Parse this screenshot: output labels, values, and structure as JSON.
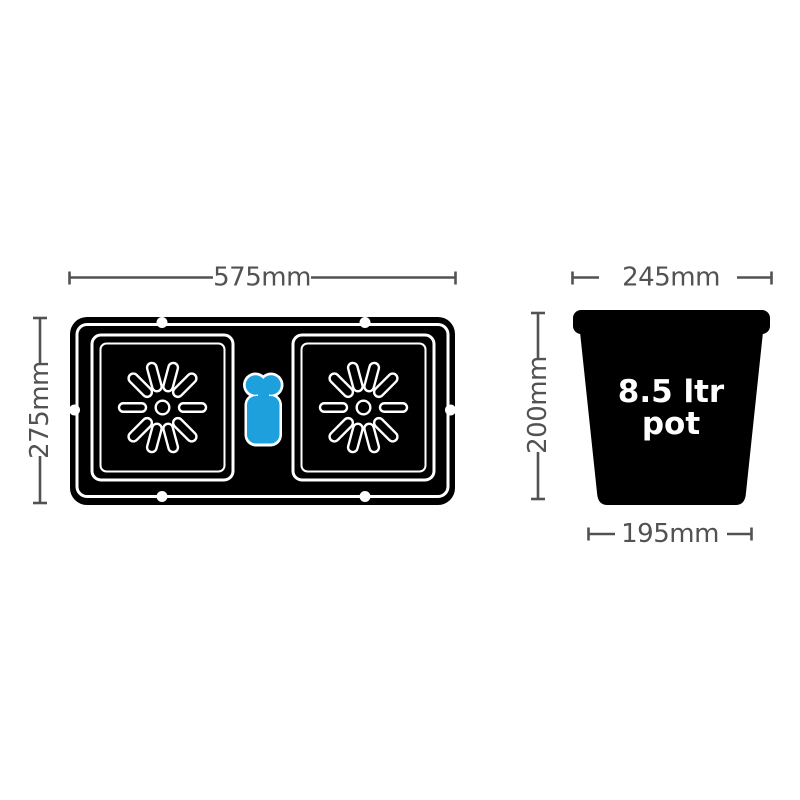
{
  "tray": {
    "width_label": "575mm",
    "depth_label": "275mm"
  },
  "pot": {
    "top_width_label": "245mm",
    "height_label": "200mm",
    "base_width_label": "195mm",
    "volume_line1": "8.5 ltr",
    "volume_line2": "pot"
  },
  "colors": {
    "background": "#ffffff",
    "product_black": "#000000",
    "outline_white": "#ffffff",
    "dimension_gray": "#515254",
    "valve_blue": "#1da0dc"
  }
}
